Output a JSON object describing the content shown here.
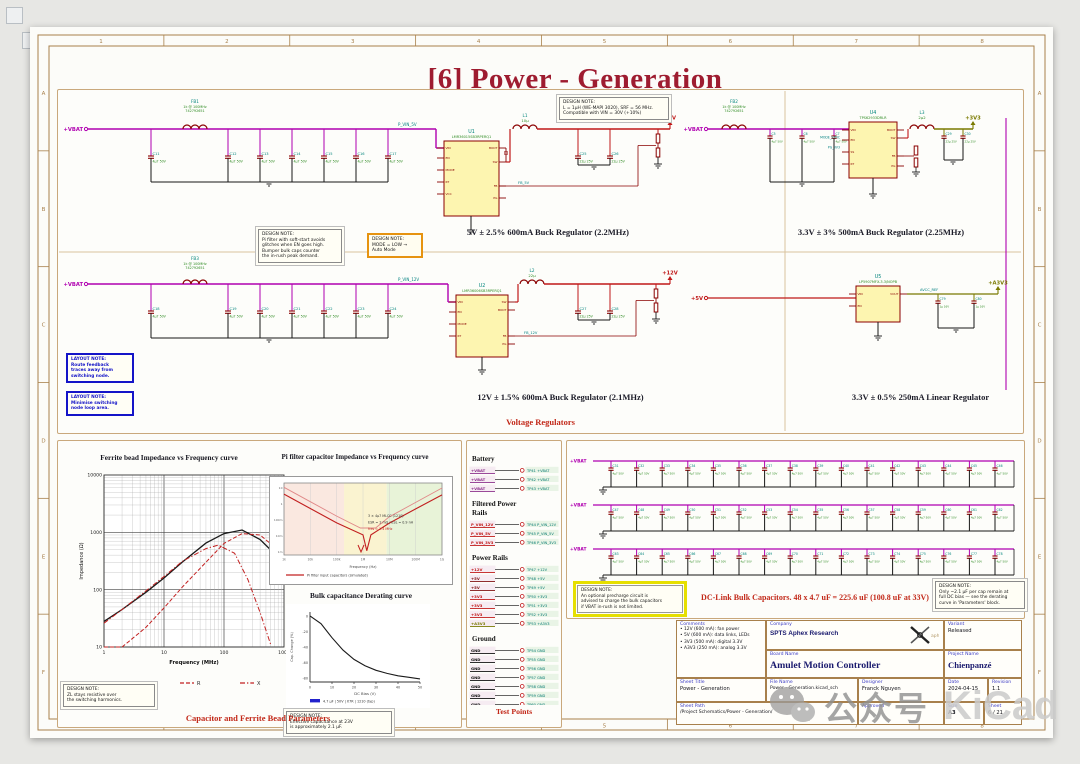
{
  "sheet": {
    "title": "[6] Power - Generation",
    "frame_cols": [
      "1",
      "2",
      "3",
      "4",
      "5",
      "6",
      "7",
      "8"
    ],
    "frame_rows": [
      "A",
      "B",
      "C",
      "D",
      "E",
      "F"
    ]
  },
  "regulators": {
    "caption": "Voltage Regulators",
    "buck5_caption": "5V ± 2.5% 600mA Buck Regulator (2.2MHz)",
    "buck3v3_caption": "3.3V ± 3% 500mA Buck Regulator (2.25MHz)",
    "buck12_caption": "12V ± 1.5% 600mA Buck Regulator (2.1MHz)",
    "ldo_caption": "3.3V ± 0.5% 250mA Linear Regulator",
    "flags": {
      "vbat": "+VBAT",
      "p5": "+5V",
      "p12": "+12V",
      "p3v3": "+3V3",
      "a3v3": "+A3V3"
    },
    "nets": {
      "pvin5": "P_VIN_5V",
      "pvin12": "P_VIN_12V",
      "fb5": "FB_5V",
      "fb12": "FB_12V",
      "mode": "MODE_SYNC",
      "pg3v3": "PG_3V3",
      "avcc": "AVCC_REF"
    },
    "parts": {
      "fb1": {
        "ref": "FB1",
        "l1": "1k @ 100MHz",
        "l2": "742792651"
      },
      "fb2": {
        "ref": "FB2",
        "l1": "1k @ 100MHz",
        "l2": "742792651"
      },
      "fb3": {
        "ref": "FB3",
        "l1": "1k @ 100MHz",
        "l2": "742792651"
      },
      "u1": {
        "ref": "U1",
        "mpn": "LMR36015SB3RPERQ1"
      },
      "u2": {
        "ref": "U2",
        "mpn": "LMR36006SB3RPERQ1"
      },
      "u4": {
        "ref": "U4",
        "mpn": "TPS62933DRLR"
      },
      "u5": {
        "ref": "U5",
        "mpn": "LP5907MFX-3.3/NOPB"
      },
      "l1": {
        "ref": "L1",
        "val": "10µ"
      },
      "l2": {
        "ref": "L2",
        "val": "22µ"
      },
      "l3": {
        "ref": "L3",
        "val": "2µ2"
      }
    },
    "cap_value": "4µ7 50V",
    "out_cap_value": "22µ 25V",
    "ldo_cap_value": "1µ 16V",
    "bank1_refs": [
      "C11",
      "C12",
      "C13",
      "C14",
      "C15",
      "C16",
      "C17"
    ],
    "bank2_refs": [
      "C18",
      "C19",
      "C20",
      "C21",
      "C22",
      "C23",
      "C24"
    ],
    "bank3_refs": [
      "C5",
      "C6",
      "C7"
    ],
    "out5_refs": [
      "C25",
      "C26"
    ],
    "out12_refs": [
      "C27",
      "C28"
    ],
    "out3v3_refs": [
      "C29",
      "C30"
    ],
    "ldo_refs": [
      "C79",
      "C80"
    ],
    "notes": {
      "top": [
        "DESIGN NOTE:",
        "L = 1µH (WE-MAPI 3020), SRF = 56 MHz.",
        "Compatible with VIN = 30V (+10%)"
      ],
      "pi": [
        "DESIGN NOTE:",
        "Pi filter with soft-start avoids",
        "glitches when EN goes high.",
        "Bumper bulk caps counter",
        "the in-rush peak demand."
      ],
      "mode": [
        "DESIGN NOTE:",
        "MODE = LOW →",
        "Auto Mode"
      ],
      "layout1": [
        "LAYOUT NOTE:",
        "Route feedback",
        "traces away from",
        "switching node."
      ],
      "layout2": [
        "LAYOUT NOTE:",
        "Minimise switching",
        "node loop area."
      ]
    }
  },
  "charts": {
    "params_caption": "Capacitor and Ferrite Bead Parameters",
    "notes": {
      "ferrite": [
        "DESIGN NOTE:",
        "ZL stays resistive over",
        "the switching harmonics."
      ],
      "derating": [
        "DESIGN NOTE:",
        "Effective capacitance at 23V",
        "is approximately 2.1 µF."
      ]
    }
  },
  "testpoints": {
    "caption": "Test Points",
    "groups": [
      {
        "heading": [
          "Battery"
        ],
        "rows": [
          {
            "net": "+VBAT",
            "color": "#8b2f8b",
            "tp": "TP41 +VBAT"
          },
          {
            "net": "+VBAT",
            "color": "#8b2f8b",
            "tp": "TP42 +VBAT"
          },
          {
            "net": "+VBAT",
            "color": "#8b2f8b",
            "tp": "TP43 +VBAT"
          }
        ]
      },
      {
        "heading": [
          "Filtered Power",
          "Rails"
        ],
        "rows": [
          {
            "net": "P_VIN_12V",
            "color": "#c01818",
            "tp": "TP44 P_VIN_12V"
          },
          {
            "net": "P_VIN_5V",
            "color": "#c01818",
            "tp": "TP45 P_VIN_5V"
          },
          {
            "net": "P_VIN_3V3",
            "color": "#c01818",
            "tp": "TP46 P_VIN_3V3"
          }
        ]
      },
      {
        "heading": [
          "Power Rails"
        ],
        "rows": [
          {
            "net": "+12V",
            "color": "#c01818",
            "tp": "TP47 +12V"
          },
          {
            "net": "+5V",
            "color": "#801010",
            "tp": "TP48 +5V"
          },
          {
            "net": "+5V",
            "color": "#801010",
            "tp": "TP49 +5V"
          },
          {
            "net": "+3V3",
            "color": "#c01818",
            "tp": "TP50 +3V3"
          },
          {
            "net": "+3V3",
            "color": "#c01818",
            "tp": "TP51 +3V3"
          },
          {
            "net": "+3V3",
            "color": "#c01818",
            "tp": "TP52 +3V3"
          },
          {
            "net": "+A3V3",
            "color": "#7a7a00",
            "tp": "TP53 +A3V3"
          }
        ]
      },
      {
        "heading": [
          "Ground"
        ],
        "rows": [
          {
            "net": "GND",
            "color": "#101010",
            "tp": "TP54 GND"
          },
          {
            "net": "GND",
            "color": "#101010",
            "tp": "TP55 GND"
          },
          {
            "net": "GND",
            "color": "#101010",
            "tp": "TP56 GND"
          },
          {
            "net": "GND",
            "color": "#101010",
            "tp": "TP57 GND"
          },
          {
            "net": "GND",
            "color": "#101010",
            "tp": "TP58 GND"
          },
          {
            "net": "GND",
            "color": "#101010",
            "tp": "TP59 GND"
          },
          {
            "net": "GND",
            "color": "#101010",
            "tp": "TP60 GND"
          }
        ]
      }
    ]
  },
  "dclink": {
    "caption": "DC-Link Bulk Capacitors. 48 x 4.7 uF = 225.6 uF (100.8 uF at 33V)",
    "flag": "+VBAT",
    "value": "4µ7 50V",
    "rows": [
      [
        "C31",
        "C32",
        "C33",
        "C34",
        "C35",
        "C36",
        "C37",
        "C38",
        "C39",
        "C40",
        "C41",
        "C42",
        "C43",
        "C44",
        "C45",
        "C46"
      ],
      [
        "C47",
        "C48",
        "C49",
        "C50",
        "C51",
        "C52",
        "C53",
        "C54",
        "C55",
        "C56",
        "C57",
        "C58",
        "C59",
        "C60",
        "C61",
        "C62"
      ],
      [
        "C63",
        "C64",
        "C65",
        "C66",
        "C67",
        "C68",
        "C69",
        "C70",
        "C71",
        "C72",
        "C73",
        "C74",
        "C75",
        "C76",
        "C77",
        "C78"
      ]
    ],
    "note_left": [
      "DESIGN NOTE:",
      "An optional precharge circuit is",
      "advised to charge the bulk capacitors",
      "if VBAT in-rush is not limited."
    ],
    "note_right": [
      "DESIGN NOTE:",
      "Only ~2.1 µF per cap remain at",
      "full DC bias — see the derating",
      "curve in 'Parameters' block."
    ]
  },
  "titleblock": {
    "labels": {
      "comments": "Comments",
      "company": "Company",
      "variant": "Variant",
      "board": "Board Name",
      "project": "Project Name",
      "sheet_title": "Sheet Title",
      "file": "File Name",
      "designer": "Designer",
      "date": "Date",
      "revision": "Revision",
      "path": "Sheet Path",
      "approved": "Approved",
      "size": "Size",
      "sheet": "Sheet"
    },
    "values": {
      "company": "SPTS Aphex Research",
      "variant": "Released",
      "board": "Amulet Motion Controller",
      "project": "Chienpanzé",
      "sheet_title": "Power - Generation",
      "file": "Power - Generation.kicad_sch",
      "designer": "Franck Nguyen",
      "date": "2024-04-15",
      "revision": "1.1",
      "path": "/Project Schematics/Power - Generation/",
      "approved": "",
      "size": "A3",
      "sheet": "6 / 21"
    },
    "comments": [
      "• 12V (600 mA): fan power",
      "• 5V (600 mA): data links, LEDs",
      "• 3V3 (500 mA): digital 3.3V",
      "• A3V3 (250 mA): analog 3.3V"
    ]
  },
  "watermark": {
    "cn": "公众号",
    "brand": "KiCad"
  },
  "chart_data": [
    {
      "type": "line",
      "title": "Ferrite bead Impedance vs Frequency curve",
      "xlabel": "Frequency (MHz)",
      "ylabel": "Impedance (Ω)",
      "xscale": "log",
      "yscale": "log",
      "xlim": [
        1,
        1000
      ],
      "ylim": [
        10,
        10000
      ],
      "xticks": [
        "1",
        "10",
        "100",
        "1000"
      ],
      "yticks": [
        "10",
        "100",
        "1000",
        "10000"
      ],
      "grid": true,
      "legend_position": "bottom",
      "series": [
        {
          "name": "Z",
          "color": "#1a1a1a",
          "style": "solid",
          "x": [
            1,
            2,
            5,
            10,
            20,
            50,
            100,
            200,
            400,
            700,
            1000
          ],
          "y": [
            28,
            45,
            90,
            160,
            300,
            650,
            950,
            1100,
            750,
            420,
            290
          ]
        },
        {
          "name": "R",
          "color": "#c22020",
          "style": "dashed",
          "x": [
            1,
            2,
            5,
            10,
            20,
            50,
            100,
            200,
            400,
            700,
            1000
          ],
          "y": [
            5,
            9,
            22,
            48,
            110,
            300,
            640,
            950,
            900,
            550,
            380
          ]
        },
        {
          "name": "X",
          "color": "#c22020",
          "style": "dashdot",
          "x": [
            1,
            2,
            5,
            10,
            20,
            50,
            80,
            150,
            250,
            400,
            600
          ],
          "y": [
            26,
            45,
            95,
            170,
            310,
            520,
            600,
            430,
            150,
            40,
            11
          ]
        }
      ]
    },
    {
      "type": "line",
      "title": "Pi filter capacitor Impedance vs Frequency curve",
      "xlabel": "Frequency (Hz)",
      "ylabel": "|Z| (Ω)",
      "xscale": "log",
      "yscale": "log",
      "xlim": [
        1000,
        1000000000
      ],
      "ylim": [
        0.002,
        200
      ],
      "xticks": [
        "1k",
        "10k",
        "100k",
        "1M",
        "10M",
        "100M",
        "1G"
      ],
      "annotations": [
        "3 × 4µ7 MLCC (1210)",
        "ESR ≈ 2 mΩ / ESL ≈ 0.9 nH",
        "fres ≈ 1.4 MHz"
      ],
      "legend": [
        "Pi filter input capacitors (simulated)"
      ],
      "series": [
        {
          "name": "3 × 4.7 µF bank",
          "color": "#c22020",
          "x": [
            1000,
            10000,
            100000,
            1000000,
            1400000,
            2000000,
            10000000,
            100000000,
            1000000000
          ],
          "y": [
            34,
            3.4,
            0.34,
            0.05,
            0.004,
            0.05,
            0.33,
            3.2,
            30
          ]
        },
        {
          "name": "single 4.7 µF",
          "color": "#e08888",
          "x": [
            1000,
            10000,
            100000,
            800000,
            3000000,
            10000000,
            100000000,
            1000000000
          ],
          "y": [
            100,
            10,
            1,
            0.15,
            0.15,
            0.9,
            9,
            90
          ]
        }
      ]
    },
    {
      "type": "line",
      "title": "Bulk capacitance Derating curve",
      "xlabel": "DC Bias (V)",
      "ylabel": "Cap. Change (%)",
      "xlim": [
        0,
        50
      ],
      "ylim": [
        -85,
        5
      ],
      "xticks": [
        "0",
        "10",
        "20",
        "30",
        "40",
        "50"
      ],
      "yticks": [
        "0",
        "-20",
        "-40",
        "-60",
        "-80"
      ],
      "legend": [
        "4.7 µF | 50V | X7R | 1210 (typ)"
      ],
      "series": [
        {
          "name": "Cap change",
          "color": "#1a1a1a",
          "x": [
            0,
            5,
            10,
            15,
            20,
            25,
            30,
            35,
            40,
            45,
            50
          ],
          "y": [
            0,
            -10,
            -28,
            -44,
            -56,
            -64,
            -70,
            -74,
            -77,
            -79,
            -81
          ]
        }
      ]
    }
  ]
}
